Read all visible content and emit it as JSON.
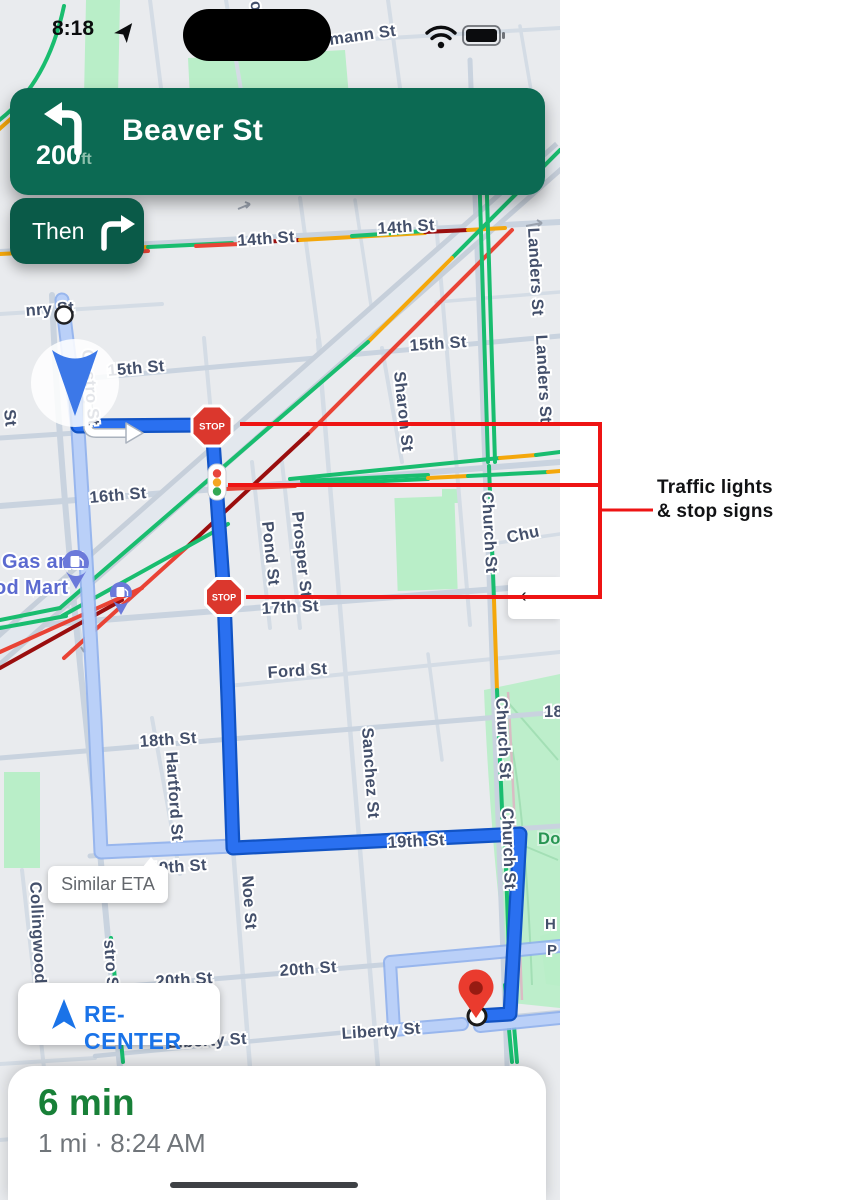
{
  "status_bar": {
    "time": "8:18"
  },
  "navigation": {
    "distance": "200",
    "unit": "ft",
    "instruction": "Beaver St",
    "then_label": "Then"
  },
  "map": {
    "stop_sign_label": "STOP",
    "labels": [
      {
        "text": "ott St"
      },
      {
        "text": "mann St"
      },
      {
        "text": "14th St"
      },
      {
        "text": "14th St"
      },
      {
        "text": "Landers St"
      },
      {
        "text": "Landers St"
      },
      {
        "text": "15th St"
      },
      {
        "text": "15th St"
      },
      {
        "text": "nry St"
      },
      {
        "text": "Sharon St"
      },
      {
        "text": "16th St"
      },
      {
        "text": "Pond St"
      },
      {
        "text": "Prosper St"
      },
      {
        "text": "Church St"
      },
      {
        "text": "Chu"
      },
      {
        "text": "17th St"
      },
      {
        "text": "Ford St"
      },
      {
        "text": "18th St"
      },
      {
        "text": "18"
      },
      {
        "text": "Hartford St"
      },
      {
        "text": "Sanchez St"
      },
      {
        "text": "Noe St"
      },
      {
        "text": "19th St"
      },
      {
        "text": "19th St"
      },
      {
        "text": "Church St"
      },
      {
        "text": "Church St"
      },
      {
        "text": "Collingwood"
      },
      {
        "text": "stro St"
      },
      {
        "text": "20th St"
      },
      {
        "text": "20th St"
      },
      {
        "text": "Liberty St"
      },
      {
        "text": "Liberty St"
      },
      {
        "text": "Dol"
      },
      {
        "text": "H"
      },
      {
        "text": "P"
      },
      {
        "text": "Gas and"
      },
      {
        "text": "od Mart"
      },
      {
        "text": "Castro St"
      },
      {
        "text": "St"
      }
    ]
  },
  "tooltip": {
    "similar_eta": "Similar ETA"
  },
  "recenter": {
    "label": "RE-CENTER"
  },
  "side_sheet": {
    "chevron": "‹"
  },
  "bottom_sheet": {
    "eta": "6 min",
    "details": "1 mi · 8:24 AM"
  },
  "annotation": {
    "line1": "Traffic lights",
    "line2": "& stop signs"
  },
  "colors": {
    "banner_green": "#0c6a53",
    "then_green": "#0a5a48",
    "route_blue": "#2a70f0",
    "alt_route_blue": "#b9cff7",
    "annotation_red": "#ee1414",
    "eta_green": "#188038",
    "link_blue": "#1a73e8",
    "traffic_green": "#19bd6f",
    "traffic_yellow": "#f4a70b",
    "traffic_red": "#e94335",
    "traffic_dark_red": "#9a0e0e",
    "stop_sign_red": "#db372d",
    "gas_pin_purple": "#6b79da",
    "destination_red": "#ea3b2e"
  }
}
